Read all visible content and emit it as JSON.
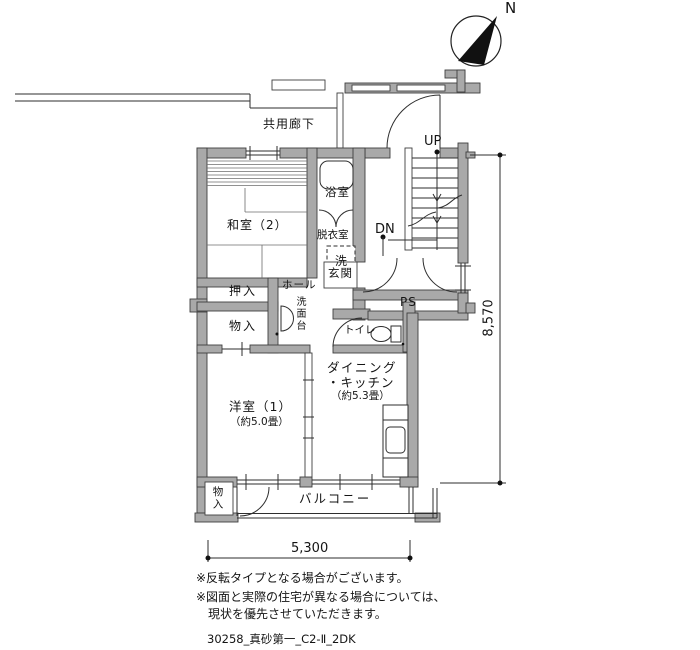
{
  "compass": {
    "north": "N"
  },
  "labels": {
    "corridor": "共用廊下",
    "up": "UP",
    "dn": "DN",
    "bath": "浴室",
    "japanese_room": "和室（2）",
    "dressing_room": "脱衣室",
    "washer": "洗",
    "entrance": "玄関",
    "pipe_space": "PS",
    "toilet": "トイレ",
    "closet": "押入",
    "storage": "物入",
    "hall": "ホール",
    "washstand": "洗面台",
    "western_room": "洋室（1）",
    "western_room_size": "（約5.0畳）",
    "dining": "ダイニング",
    "kitchen": "・キッチン",
    "dk_size": "（約5.3畳）",
    "balcony": "バルコニー",
    "balcony_storage": "物入"
  },
  "dimensions": {
    "width": "5,300",
    "height": "8,570"
  },
  "notes": [
    "※反転タイプとなる場合がございます。",
    "※図面と実際の住宅が異なる場合については、",
    "現状を優先させていただきます。"
  ],
  "plan_id": "30258_真砂第一_C2-Ⅱ_2DK"
}
